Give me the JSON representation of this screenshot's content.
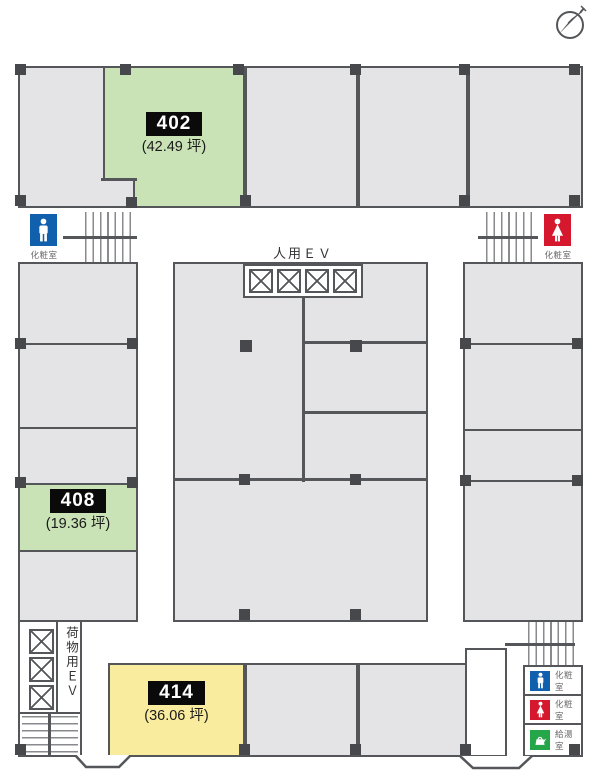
{
  "title": "floor-plan-4f",
  "compass": {
    "icon": "north-compass"
  },
  "rooms": {
    "r402": {
      "number": "402",
      "area": "(42.49 坪)",
      "highlight": "#c9e2b6"
    },
    "r408": {
      "number": "408",
      "area": "(19.36 坪)",
      "highlight": "#c9e2b6"
    },
    "r414": {
      "number": "414",
      "area": "(36.06 坪)",
      "highlight": "#f9ec9e"
    }
  },
  "labels": {
    "passenger_ev": "人用ＥＶ",
    "freight_ev": "荷物用ＥＶ",
    "restroom": "化粧室",
    "kitchenette": "給湯室"
  },
  "legend": [
    {
      "icon": "mens-restroom",
      "color": "#1160ae",
      "label": "化粧室"
    },
    {
      "icon": "womens-restroom",
      "color": "#d5182e",
      "label": "化粧室"
    },
    {
      "icon": "kitchenette",
      "color": "#25a749",
      "label": "給湯室"
    }
  ],
  "colors": {
    "room_fill": "#e4e4e6",
    "wall": "#54565a",
    "highlight_green": "#c9e2b6",
    "highlight_yellow": "#f9ec9e",
    "mens_blue": "#1160ae",
    "womens_red": "#d5182e",
    "kitchen_green": "#25a749",
    "label_chip_bg": "#0a0a0a"
  }
}
